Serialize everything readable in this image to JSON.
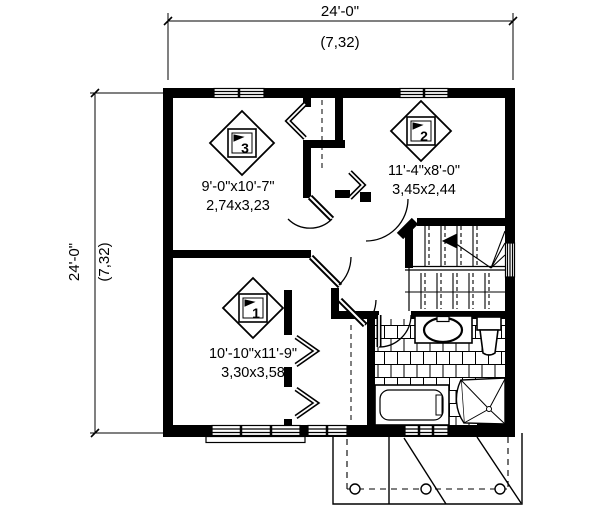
{
  "drawing": {
    "type": "floor-plan",
    "colors": {
      "line": "#000000",
      "background": "#ffffff"
    },
    "top_dimension": {
      "imperial": "24'-0\"",
      "metric": "(7,32)"
    },
    "left_dimension": {
      "imperial": "24'-0\"",
      "metric": "(7,32)"
    },
    "rooms": [
      {
        "number": "1",
        "imperial": "10'-10\"x11'-9\"",
        "metric": "3,30x3,58"
      },
      {
        "number": "2",
        "imperial": "11'-4\"x8'-0\"",
        "metric": "3,45x2,44"
      },
      {
        "number": "3",
        "imperial": "9'-0\"x10'-7\"",
        "metric": "2,74x3,23"
      }
    ]
  }
}
